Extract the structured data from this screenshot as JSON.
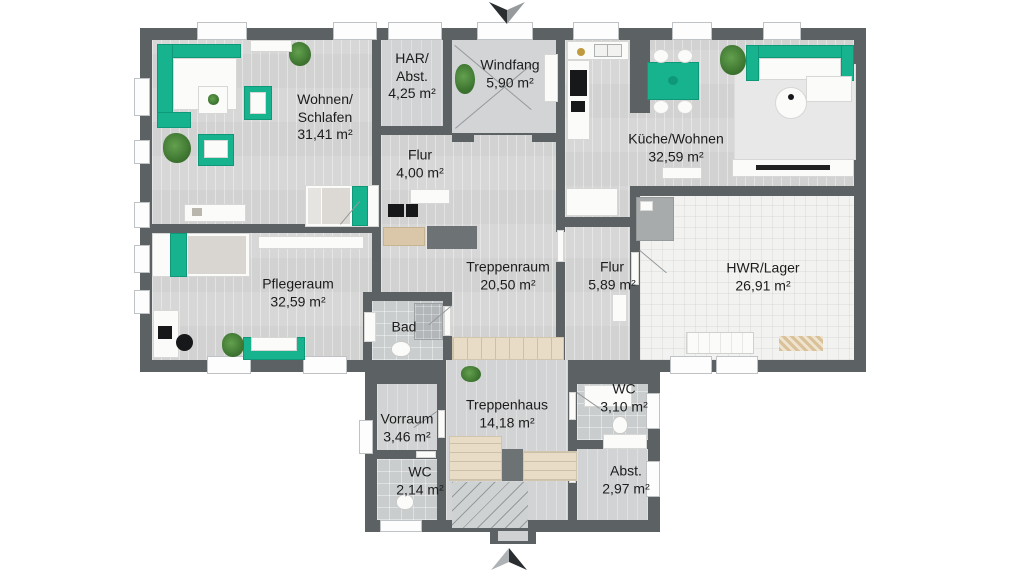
{
  "colors": {
    "wall": "#5c6164",
    "floor_wood": "#d6d7d6",
    "floor_tile_bath": "#c9cdce",
    "floor_tile_storage": "#f2f3f1",
    "furniture_teal": "#17b28e",
    "stairs_beige": "#e9dcc6",
    "plant_green": "#4d8a3e",
    "label_text": "#1c1c1c"
  },
  "rooms": [
    {
      "key": "wohnen_schlafen",
      "name": "Wohnen/\nSchlafen",
      "area": "31,41 m²"
    },
    {
      "key": "har_abst",
      "name": "HAR/\nAbst.",
      "area": "4,25 m²"
    },
    {
      "key": "windfang",
      "name": "Windfang",
      "area": "5,90 m²"
    },
    {
      "key": "flur_og",
      "name": "Flur",
      "area": "4,00 m²"
    },
    {
      "key": "kueche_wohnen",
      "name": "Küche/Wohnen",
      "area": "32,59 m²"
    },
    {
      "key": "treppenraum",
      "name": "Treppenraum",
      "area": "20,50 m²"
    },
    {
      "key": "flur_mitte",
      "name": "Flur",
      "area": "5,89 m²"
    },
    {
      "key": "hwr_lager",
      "name": "HWR/Lager",
      "area": "26,91 m²"
    },
    {
      "key": "pflegeraum",
      "name": "Pflegeraum",
      "area": "32,59 m²"
    },
    {
      "key": "bad",
      "name": "Bad",
      "area": ""
    },
    {
      "key": "vorraum",
      "name": "Vorraum",
      "area": "3,46 m²"
    },
    {
      "key": "wc_links",
      "name": "WC",
      "area": "2,14 m²"
    },
    {
      "key": "treppenhaus",
      "name": "Treppenhaus",
      "area": "14,18 m²"
    },
    {
      "key": "wc_rechts",
      "name": "WC",
      "area": "3,10 m²"
    },
    {
      "key": "abstellraum",
      "name": "Abst.",
      "area": "2,97 m²"
    }
  ],
  "icons": {
    "entry_arrow_top": "chevron-down",
    "entry_arrow_bottom": "chevron-up"
  }
}
